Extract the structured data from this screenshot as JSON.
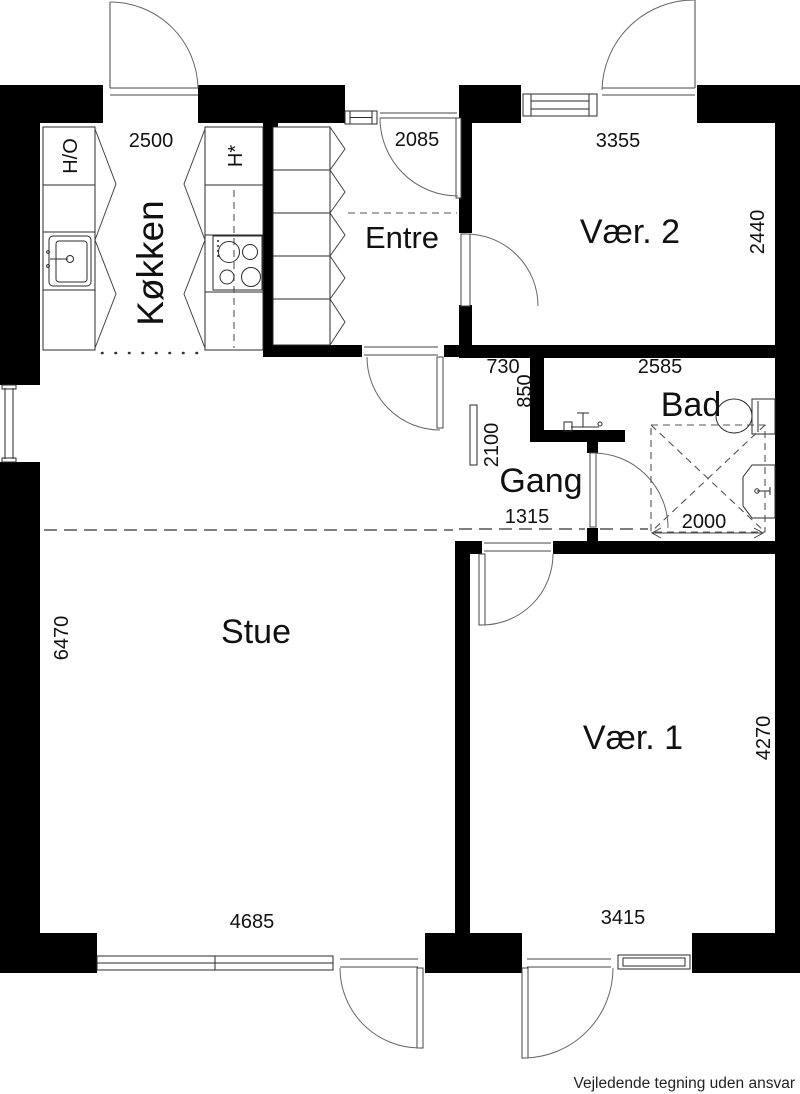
{
  "rooms": {
    "kitchen": {
      "label": "Køkken"
    },
    "entre": {
      "label": "Entre"
    },
    "room2": {
      "label": "Vær. 2"
    },
    "bath": {
      "label": "Bad"
    },
    "hall": {
      "label": "Gang"
    },
    "living": {
      "label": "Stue"
    },
    "room1": {
      "label": "Vær. 1"
    }
  },
  "appliances": {
    "left_tall_unit": "H/O",
    "right_tall_unit": "H*"
  },
  "dimensions": {
    "kitchen_width": "2500",
    "entre_width": "2085",
    "room2_width": "3355",
    "room2_depth": "2440",
    "hall_offset": "730",
    "bath_width": "2585",
    "bath_wall_stub": "850",
    "hall_length": "2100",
    "hall_width": "1315",
    "bath_depth": "2000",
    "living_depth": "6470",
    "living_width": "4685",
    "room1_width": "3415",
    "room1_depth": "4270"
  },
  "footer": {
    "disclaimer": "Vejledende tegning uden ansvar"
  },
  "colors": {
    "walls": "#000000",
    "lines": "#2b2b2b",
    "background": "#ffffff"
  }
}
